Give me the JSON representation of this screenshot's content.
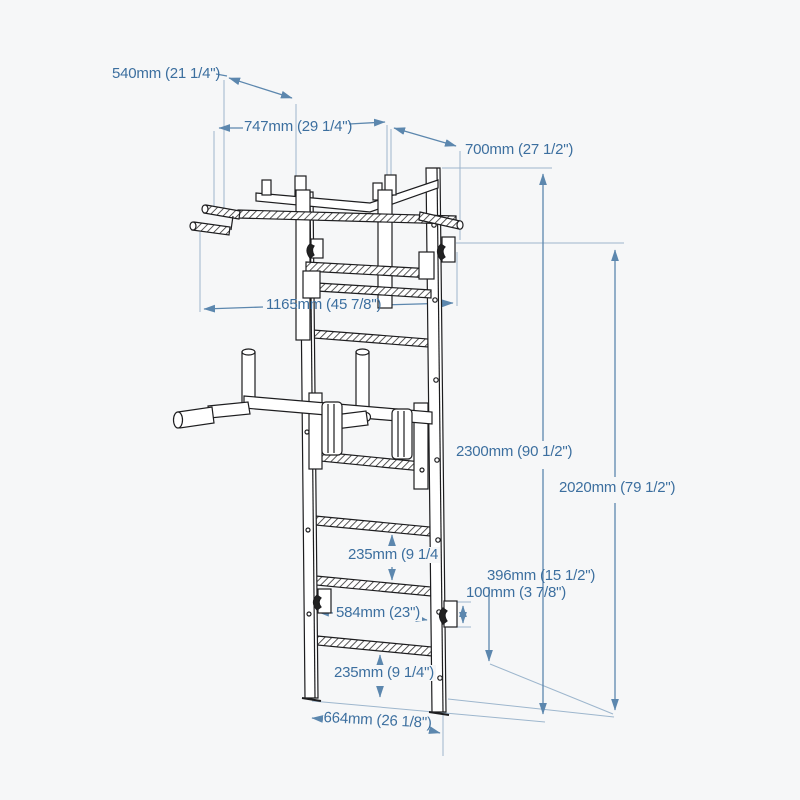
{
  "diagram": {
    "type": "technical-dimension-drawing",
    "subject": "Wall-mounted gymnastics ladder (wall bars) with pull-up bar and dip attachment",
    "colors": {
      "background": "#f6f7f8",
      "line_art": "#1d1d1f",
      "dimension_lines": "#5c87ae",
      "extension_lines": "#9db6cd",
      "label_text": "#3c6f9f"
    },
    "dimensions": {
      "d540": {
        "label": "540mm (21 1/4\")",
        "meaning": "pull-up bar grip offset"
      },
      "d747": {
        "label": "747mm (29 1/4\")",
        "meaning": "pull-up bar depth"
      },
      "d700": {
        "label": "700mm (27 1/2\")",
        "meaning": "mount spacing"
      },
      "d1165": {
        "label": "1165mm (45 7/8\")",
        "meaning": "overall width"
      },
      "d2300": {
        "label": "2300mm (90 1/2\")",
        "meaning": "overall height"
      },
      "d2020": {
        "label": "2020mm (79 1/2\")",
        "meaning": "ladder height"
      },
      "d235_upper": {
        "label": "235mm (9 1/4",
        "meaning": "rung spacing"
      },
      "d396": {
        "label": "396mm (15 1/2\")",
        "meaning": "bracket height from floor"
      },
      "d100": {
        "label": "100mm (3 7/8\")",
        "meaning": "bracket plate height"
      },
      "d584": {
        "label": "584mm (23\")",
        "meaning": "bracket spacing"
      },
      "d235_lower": {
        "label": "235mm (9 1/4\")",
        "meaning": "rung spacing"
      },
      "d664": {
        "label": "664mm (26 1/8\")",
        "meaning": "ladder width"
      }
    }
  }
}
